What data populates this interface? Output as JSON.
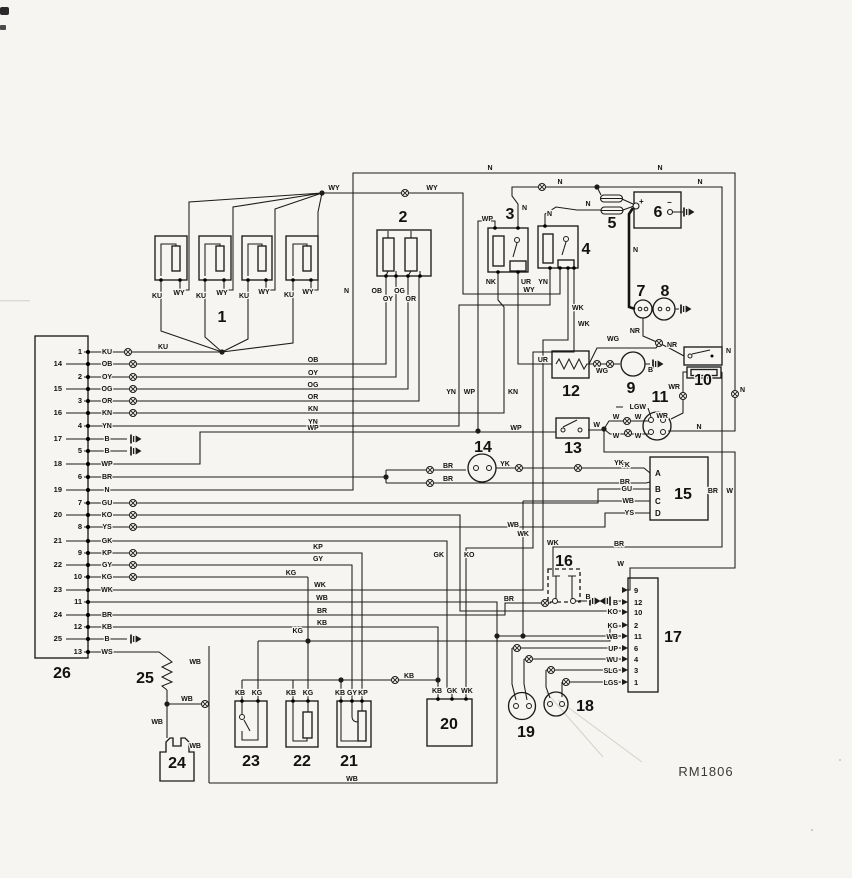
{
  "doc": {
    "ref": "RM1806"
  },
  "n": {
    "c1": "1",
    "c2": "2",
    "c3": "3",
    "c4": "4",
    "c5": "5",
    "c6": "6",
    "c7": "7",
    "c8": "8",
    "c9": "9",
    "c10": "10",
    "c11": "11",
    "c12": "12",
    "c13": "13",
    "c14": "14",
    "c15": "15",
    "c16": "16",
    "c17": "17",
    "c18": "18",
    "c19": "19",
    "c20": "20",
    "c21": "21",
    "c22": "22",
    "c23": "23",
    "c24": "24",
    "c25": "25",
    "c26": "26"
  },
  "sym": {
    "plus": "+",
    "minus": "−"
  },
  "w": {
    "WY": "WY",
    "KU": "KU",
    "N": "N",
    "OB": "OB",
    "OY": "OY",
    "OG": "OG",
    "OR": "OR",
    "KN": "KN",
    "NK": "NK",
    "YN": "YN",
    "WP": "WP",
    "B": "B",
    "BR": "BR",
    "GU": "GU",
    "KO": "KO",
    "YS": "YS",
    "GK": "GK",
    "KP": "KP",
    "GY": "GY",
    "KG": "KG",
    "WK": "WK",
    "WB": "WB",
    "KB": "KB",
    "WS": "WS",
    "UR": "UR",
    "WG": "WG",
    "NR": "NR",
    "WR": "WR",
    "LGW": "LGW",
    "W": "W",
    "YK": "YK",
    "UP": "UP",
    "WU": "WU",
    "SLG": "SLG",
    "LGS": "LGS"
  },
  "c26": {
    "pins": [
      {
        "n": "1",
        "wire": "KU"
      },
      {
        "n": "14",
        "wire": "OB"
      },
      {
        "n": "2",
        "wire": "OY"
      },
      {
        "n": "15",
        "wire": "OG"
      },
      {
        "n": "3",
        "wire": "OR"
      },
      {
        "n": "16",
        "wire": "KN"
      },
      {
        "n": "4",
        "wire": "YN"
      },
      {
        "n": "17",
        "wire": "B"
      },
      {
        "n": "5",
        "wire": "B"
      },
      {
        "n": "18",
        "wire": "WP"
      },
      {
        "n": "6",
        "wire": "BR"
      },
      {
        "n": "19",
        "wire": "N"
      },
      {
        "n": "7",
        "wire": "GU"
      },
      {
        "n": "20",
        "wire": "KO"
      },
      {
        "n": "8",
        "wire": "YS"
      },
      {
        "n": "21",
        "wire": "GK"
      },
      {
        "n": "9",
        "wire": "KP"
      },
      {
        "n": "22",
        "wire": "GY"
      },
      {
        "n": "10",
        "wire": "KG"
      },
      {
        "n": "23",
        "wire": "WK"
      },
      {
        "n": "11",
        "wire": ""
      },
      {
        "n": "24",
        "wire": "BR"
      },
      {
        "n": "12",
        "wire": "KB"
      },
      {
        "n": "25",
        "wire": "B"
      },
      {
        "n": "13",
        "wire": "WS"
      }
    ]
  },
  "c17": {
    "pins": [
      {
        "n": "9",
        "wire": ""
      },
      {
        "n": "12",
        "wire": "B"
      },
      {
        "n": "10",
        "wire": "KO"
      },
      {
        "n": "2",
        "wire": "KG"
      },
      {
        "n": "11",
        "wire": "WB"
      },
      {
        "n": "6",
        "wire": "UP"
      },
      {
        "n": "4",
        "wire": "WU"
      },
      {
        "n": "3",
        "wire": "SLG"
      },
      {
        "n": "1",
        "wire": "LGS"
      }
    ]
  },
  "c15": {
    "pins": [
      {
        "n": "A",
        "wire": "YK"
      },
      {
        "n": "",
        "wire": "BR"
      },
      {
        "n": "B",
        "wire": "GU"
      },
      {
        "n": "C",
        "wire": "WB"
      },
      {
        "n": "D",
        "wire": "YS"
      }
    ]
  }
}
